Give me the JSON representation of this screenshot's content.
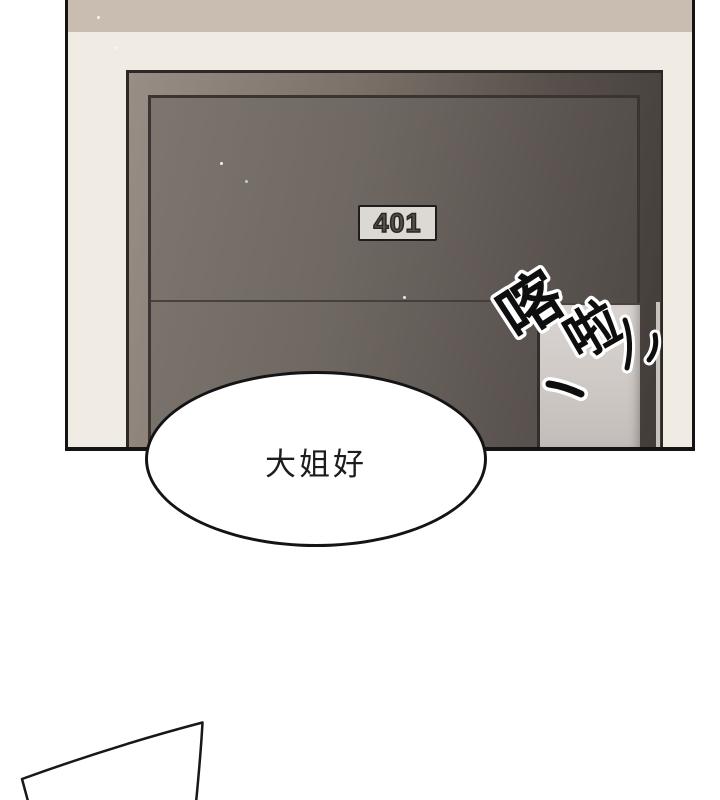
{
  "scene": {
    "description": "comic panel of apartment door opening",
    "door": {
      "sign": "401"
    },
    "bubble": {
      "text": "大姐好"
    },
    "sfx": {
      "char1": "喀",
      "char2": "啦",
      "marks": [
        "dash-stroke",
        "tick-stroke",
        "tick-stroke"
      ]
    },
    "colors": {
      "wall_cream": "#f1ece3",
      "ceiling_band": "#c9bdb1",
      "door_light": "#7d756e",
      "door_dark": "#4e4844",
      "frame_light": "#988e85",
      "frame_dark": "#423c38",
      "light_strip_top": "#dad5d2",
      "light_strip_bottom": "#c3bdba",
      "sign_plate": "#dcd9d4",
      "panel_border": "#161412",
      "bubble_fill": "#ffffff",
      "text": "#1c1c1c"
    }
  }
}
